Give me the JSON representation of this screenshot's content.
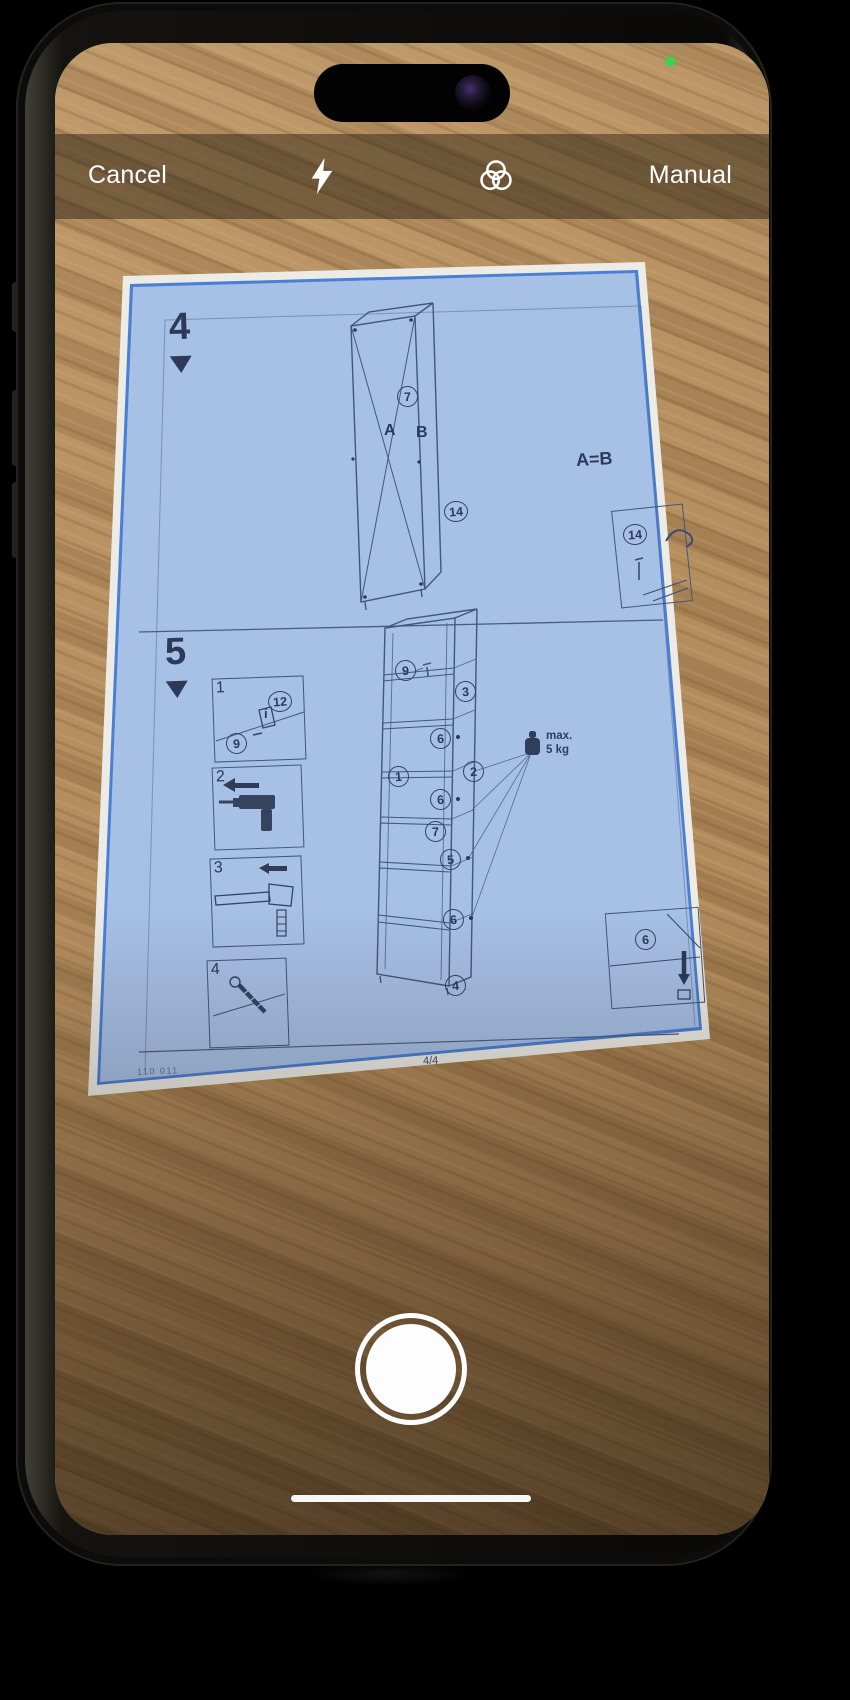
{
  "device": {
    "camera_active_indicator": "green-dot"
  },
  "top_bar": {
    "cancel_label": "Cancel",
    "manual_label": "Manual",
    "flash_icon": "flash-bolt",
    "filters_icon": "three-overlapping-circles"
  },
  "scanner": {
    "overlay_color": "#a6c0e6",
    "detection_border_color": "#4a7fd4"
  },
  "document": {
    "step4": {
      "number": "4",
      "part_circle_top": "7",
      "label_a": "A",
      "label_b": "B",
      "part_circle_side": "14",
      "equality_note": "A=B",
      "detail_part": "14"
    },
    "step5": {
      "number": "5",
      "tool_boxes": [
        {
          "number": "1",
          "part_a": "12",
          "part_b": "9",
          "info": "i"
        },
        {
          "number": "2"
        },
        {
          "number": "3"
        },
        {
          "number": "4"
        }
      ],
      "tower_labels": [
        "9",
        "3",
        "6",
        "1",
        "2",
        "6",
        "7",
        "5",
        "6",
        "4"
      ],
      "weight_line1": "max.",
      "weight_line2": "5 kg",
      "detail_part": "6"
    },
    "footer": {
      "page": "4/4",
      "code": "110 011"
    }
  }
}
